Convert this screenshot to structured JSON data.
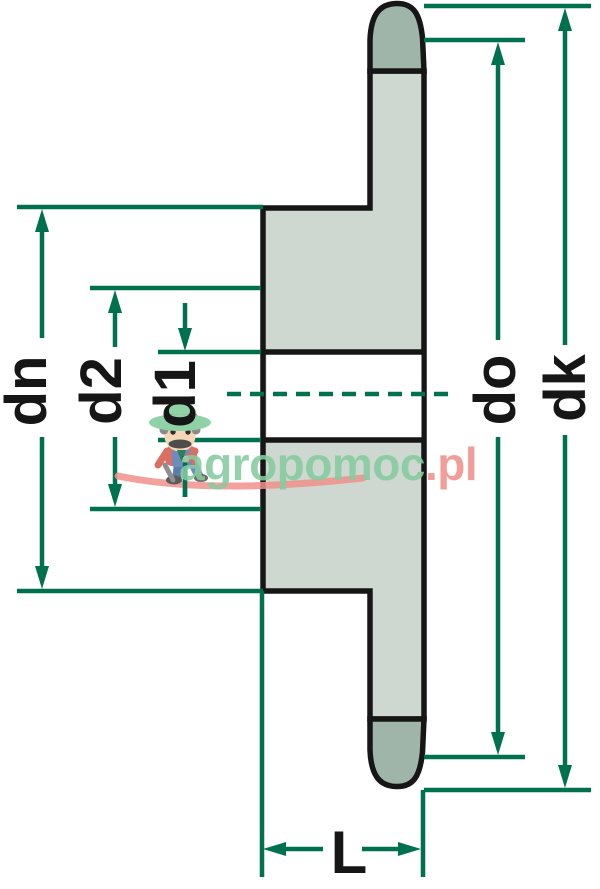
{
  "drawing": {
    "type": "sprocket-cross-section-dimensional-drawing",
    "labels": {
      "dn": "dn",
      "d2": "d2",
      "d1": "d1",
      "do": "do",
      "dk": "dk",
      "length": "L"
    }
  },
  "watermark": {
    "brand": "agropomoc",
    "tld": ".pl"
  },
  "colors": {
    "dimension": "#00714F",
    "outline": "#161616",
    "body_fill": "#CFD8D0",
    "tooth_fill": "#9FB5AA",
    "bore_fill": "#FFFFFF",
    "watermark_green": "#86CBA0",
    "watermark_pink": "#F0908C",
    "figure_hat": "#8FD2A5",
    "figure_hat_band": "#B85454",
    "figure_skin": "#F4D7B5",
    "figure_shirt": "#D96F62",
    "figure_overalls": "#6D8CBC"
  }
}
